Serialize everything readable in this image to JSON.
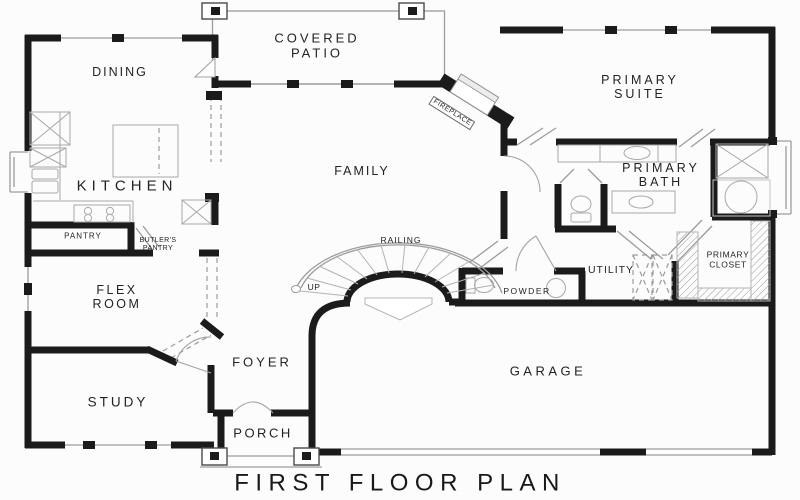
{
  "plan": {
    "title": "FIRST FLOOR PLAN"
  },
  "labels": {
    "dining": "DINING",
    "covered_patio": "COVERED\nPATIO",
    "primary_suite": "PRIMARY\nSUITE",
    "kitchen": "KITCHEN",
    "family": "FAMILY",
    "primary_bath": "PRIMARY\nBATH",
    "pantry": "PANTRY",
    "butlers_pantry": "BUTLER'S\nPANTRY",
    "flex_room": "FLEX\nROOM",
    "railing": "RAILING",
    "up": "UP",
    "utility": "UTILITY",
    "primary_closet": "PRIMARY\nCLOSET",
    "powder": "POWDER",
    "foyer": "FOYER",
    "garage": "GARAGE",
    "study": "STUDY",
    "porch": "PORCH",
    "fireplace": "FIREPLACE"
  },
  "colors": {
    "wall": "#1b1b1b",
    "thin_line": "#9b9b9b",
    "background": "#fcfcfc",
    "text": "#232323"
  }
}
